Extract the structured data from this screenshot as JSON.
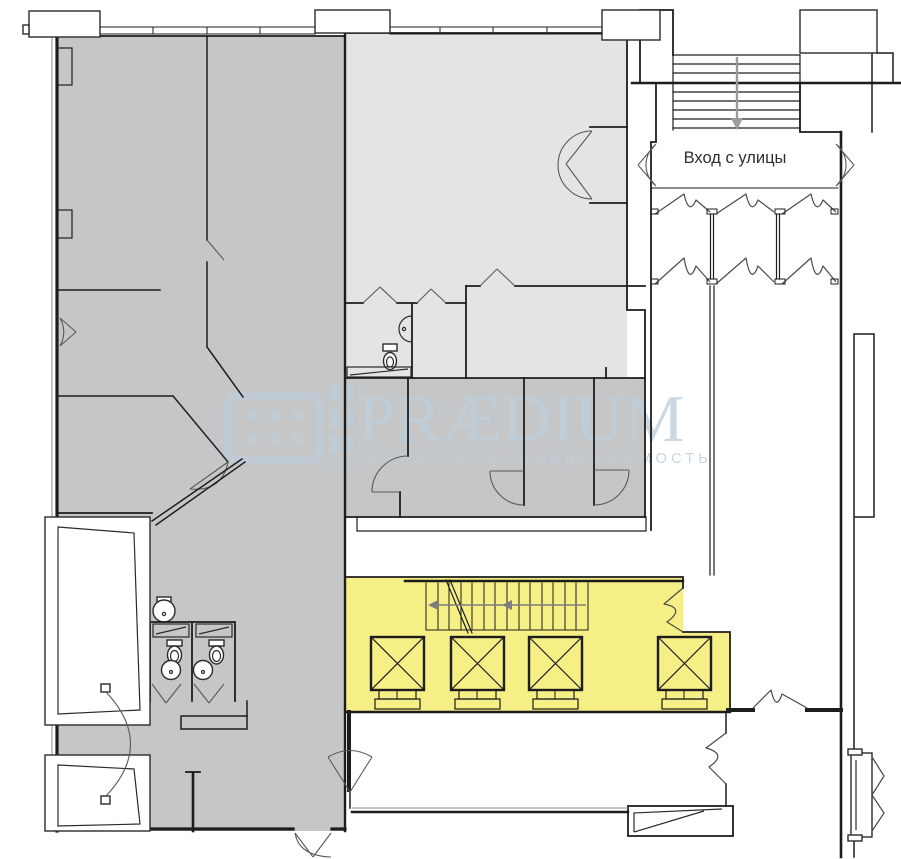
{
  "page": {
    "width": 901,
    "height": 859,
    "background": "#ffffff"
  },
  "colors": {
    "room_dark_gray": "#c4c6c8",
    "room_light_gray": "#e3e4e6",
    "highlight_yellow": "#f6ef85",
    "wall_line": "#1d1d1d",
    "door_line": "#5a5a5a",
    "arrow_gray": "#9b9b9b",
    "watermark_blue": "#bdcfdd",
    "label_text": "#2f2f2f"
  },
  "labels": {
    "street_entrance": "Вход с улицы"
  },
  "watermark": {
    "brand": "PRÆDIUM",
    "tagline": "КОММЕРЧЕСКАЯ НЕДВИЖИМОСТЬ"
  },
  "plan": {
    "type": "floor-plan",
    "elevators": 4,
    "toilets": 3,
    "sinks": 4,
    "staircases": 2
  }
}
